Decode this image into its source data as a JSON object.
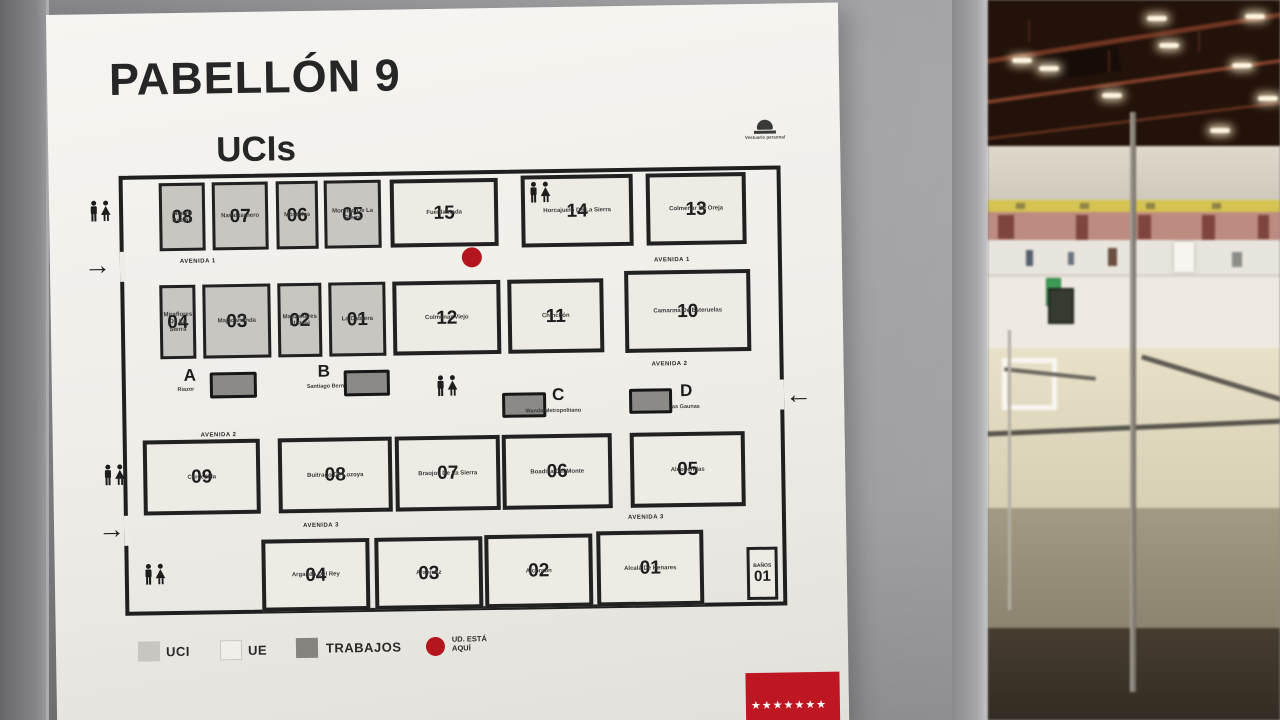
{
  "sign": {
    "title": "PABELLÓN 9",
    "subtitle": "UCIs",
    "staff_room_note": "Vestuario personal",
    "banos_label": "BAÑOS",
    "banos_num": "01"
  },
  "map": {
    "row1": [
      {
        "num": "08",
        "name": "Nuevo Baztán",
        "type": "uci"
      },
      {
        "num": "07",
        "name": "Navalcarnero",
        "type": "uci"
      },
      {
        "num": "06",
        "name": "Móstoles",
        "type": "uci"
      },
      {
        "num": "05",
        "name": "Montejo De La Sierra",
        "type": "uci"
      },
      {
        "num": "15",
        "name": "Fuenlabrada",
        "type": "ue"
      },
      {
        "num": "14",
        "name": "Horcajuelo De La Sierra",
        "type": "ue"
      },
      {
        "num": "13",
        "name": "Colmenar De Oreja",
        "type": "ue"
      }
    ],
    "row2": [
      {
        "num": "04",
        "name": "Miraflores De La Sierra",
        "type": "uci"
      },
      {
        "num": "03",
        "name": "Majadahonda",
        "type": "uci"
      },
      {
        "num": "02",
        "name": "Manzanares El Real",
        "type": "uci"
      },
      {
        "num": "01",
        "name": "La Cabrera",
        "type": "uci"
      },
      {
        "num": "12",
        "name": "Colmenar Viejo",
        "type": "ue"
      },
      {
        "num": "11",
        "name": "Chinchón",
        "type": "ue"
      },
      {
        "num": "10",
        "name": "Camarma De Esteruelas",
        "type": "ue"
      }
    ],
    "work": [
      {
        "letter": "A",
        "name": "Riazor"
      },
      {
        "letter": "B",
        "name": "Santiago Bernabéu"
      },
      {
        "letter": "C",
        "name": "Wanda Metropolitano"
      },
      {
        "letter": "D",
        "name": "Las Gaunas"
      }
    ],
    "row4": [
      {
        "num": "09",
        "name": "Cercedilla",
        "type": "ue"
      },
      {
        "num": "08",
        "name": "Buitrago De Lozoya",
        "type": "ue"
      },
      {
        "num": "07",
        "name": "Braojos De La Sierra",
        "type": "ue"
      },
      {
        "num": "06",
        "name": "Boadilla Del Monte",
        "type": "ue"
      },
      {
        "num": "05",
        "name": "Alcobendas",
        "type": "ue"
      }
    ],
    "row5": [
      {
        "num": "04",
        "name": "Arganda Del Rey",
        "type": "ue"
      },
      {
        "num": "03",
        "name": "Aranjuez",
        "type": "ue"
      },
      {
        "num": "02",
        "name": "Alcorcón",
        "type": "ue"
      },
      {
        "num": "01",
        "name": "Alcalá De Henares",
        "type": "ue"
      }
    ],
    "avenues": {
      "a1": "AVENIDA 1",
      "a2": "AVENIDA 2",
      "a3": "AVENIDA 3"
    }
  },
  "legend": {
    "uci": "UCI",
    "ue": "UE",
    "trabajos": "TRABAJOS",
    "you_are_here": "UD. ESTÁ AQUÍ"
  },
  "icons": {
    "entrance_arrow": "→",
    "exit_arrow": "←",
    "logo_star": "★"
  },
  "colors": {
    "accent_red": "#b5151d",
    "uci_fill": "#c8c6c1",
    "trabajos_fill": "#8b8a86",
    "madrid_red": "#bf1722"
  }
}
